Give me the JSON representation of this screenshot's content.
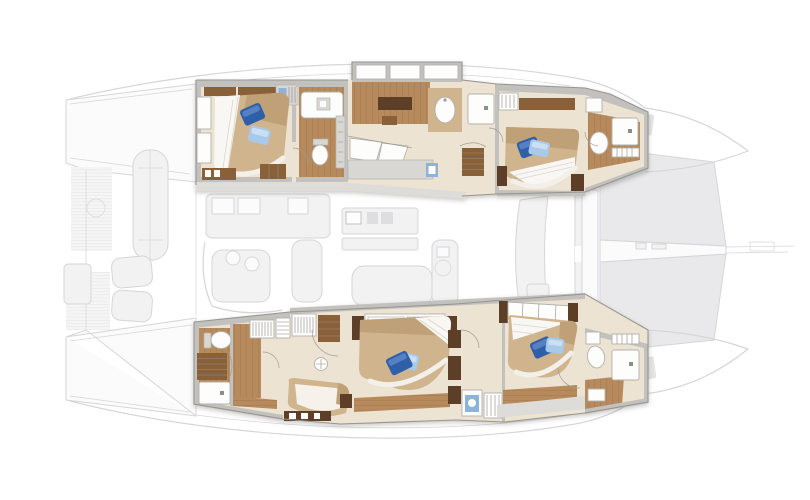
{
  "palette": {
    "bg": "#ffffff",
    "ghost-fill": "#f0f0f1",
    "ghost-stroke": "#cfcfd3",
    "tramp": "#e6e6e8",
    "wall": "#c2c1be",
    "wall-line": "#8f8d88",
    "floor-cream": "#ece3d2",
    "walkway": "#dedcd8",
    "wood": "#b68a5c",
    "wood-line": "#9a7147",
    "wood-dark": "#5c3f26",
    "wood-shelf": "#8a6038",
    "bed-tan": "#cfb48e",
    "bed-tan-dark": "#c0a077",
    "duvet": "#f8f7f3",
    "fixture-white": "#fdfdfc",
    "fixture-stroke": "#b3b1ac",
    "cabinet": "#d9d7d3",
    "pillow-dark": "#2f5fa9",
    "pillow-dark-hi": "#5581c4",
    "pillow-light": "#a9c9ea",
    "pillow-light-hi": "#cadff4",
    "glass-blue": "#8db3d8"
  },
  "plan": {
    "kind": "catamaran-accommodation-deck-plan",
    "orientation": "bow-right",
    "highlighted_rooms": [
      {
        "id": "upper-aft-cabin",
        "kind": "guest-cabin",
        "features": [
          "double-bed",
          "dark-blue-pillow",
          "light-blue-pillow",
          "wardrobe",
          "hull-windows",
          "sideboard",
          "steps"
        ]
      },
      {
        "id": "upper-aft-bathroom",
        "kind": "bathroom",
        "features": [
          "washbasin",
          "toilet",
          "storage-column"
        ]
      },
      {
        "id": "upper-mid-ensuite",
        "kind": "ensuite-bathroom",
        "features": [
          "bathtub",
          "shower",
          "twin-washbasins",
          "tv-cabinet",
          "stairs",
          "vanity-counter"
        ]
      },
      {
        "id": "upper-fwd-cabin",
        "kind": "guest-cabin",
        "features": [
          "double-bed",
          "dark-blue-pillow",
          "light-blue-pillow",
          "wardrobe",
          "shelf",
          "nightstands"
        ]
      },
      {
        "id": "upper-fwd-bathroom",
        "kind": "bathroom",
        "features": [
          "toilet",
          "shower",
          "towel-shelf"
        ]
      },
      {
        "id": "lower-aft-ensuite",
        "kind": "bathroom-dressing",
        "features": [
          "toilet",
          "shower",
          "stairs",
          "walk-in-wardrobe"
        ]
      },
      {
        "id": "lower-mid-cabin",
        "kind": "guest-cabin",
        "features": [
          "double-bed",
          "dark-blue-pillow",
          "light-blue-pillow",
          "wardrobe",
          "shelves",
          "chaise-sofa",
          "stool",
          "sideboard"
        ]
      },
      {
        "id": "lower-utility",
        "kind": "corridor-utility",
        "features": [
          "washing-machine",
          "shelf-unit"
        ]
      },
      {
        "id": "lower-fwd-cabin",
        "kind": "guest-cabin",
        "features": [
          "double-bed",
          "dark-blue-pillow",
          "light-blue-pillow",
          "hull-windows",
          "nightstands",
          "bench"
        ]
      },
      {
        "id": "lower-fwd-bathroom",
        "kind": "bathroom",
        "features": [
          "toilet",
          "shower",
          "towel-shelf",
          "bath-mat"
        ]
      }
    ],
    "ghosted_areas": [
      "aft-swim-platforms",
      "tender",
      "aft-cockpit",
      "saloon-galley",
      "saloon-dining",
      "galley-island",
      "saloon-sofa",
      "armchair",
      "forward-cockpit",
      "bow-trampoline",
      "anchor-channel",
      "bowsprit",
      "deck-hatches",
      "hull-outline"
    ]
  }
}
